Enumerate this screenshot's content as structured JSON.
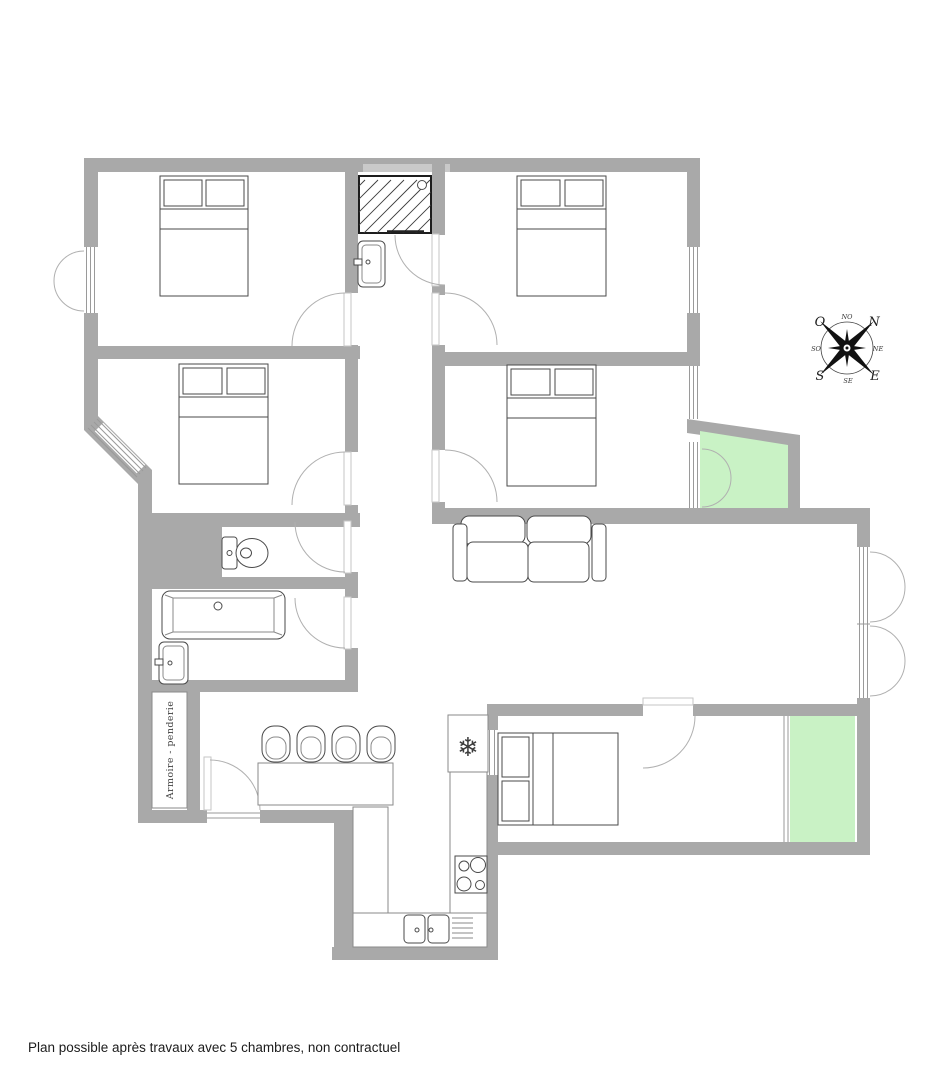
{
  "caption": "Plan possible après travaux avec 5 chambres, non contractuel",
  "closet_label": "Armoire - penderie",
  "compass": {
    "cardinal": {
      "west": "O",
      "north": "N",
      "east": "E",
      "south": "S"
    },
    "intercardinal": {
      "top": "NO",
      "right": "NE",
      "bottom": "SE",
      "left": "SO"
    }
  },
  "icons": {
    "snowflake": "❄"
  },
  "colors": {
    "wall": "#a9a9a9",
    "wall-light": "#c9c9c9",
    "balcony-green": "#c9f2c5",
    "furniture-line": "#4a4a4a",
    "door-arc": "#b0b0b0",
    "window-line": "#9a9a9a",
    "shower-hatch": "#3a3a3a",
    "text": "#1c1c1c"
  }
}
